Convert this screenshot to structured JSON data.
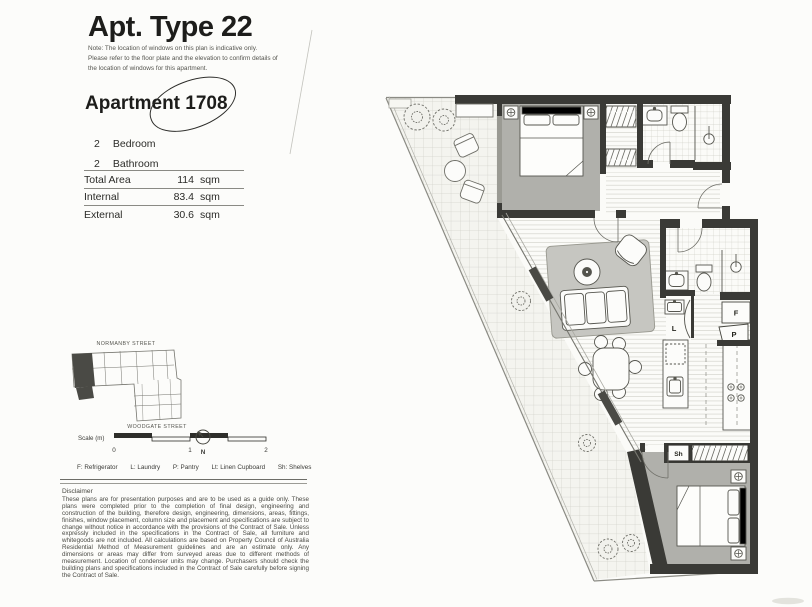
{
  "header": {
    "title": "Apt. Type 22",
    "note": "Note: The location of windows on this plan is indicative only. Please refer to the floor plate and the elevation to confirm details of the location of windows for this apartment.",
    "apartment_word": "Apartment",
    "apartment_number": "1708"
  },
  "summary": {
    "rooms": [
      {
        "count": "2",
        "label": "Bedroom"
      },
      {
        "count": "2",
        "label": "Bathroom"
      }
    ],
    "areas": [
      {
        "label": "Total Area",
        "value": "114",
        "unit": "sqm"
      },
      {
        "label": "Internal",
        "value": "83.4",
        "unit": "sqm"
      },
      {
        "label": "External",
        "value": "30.6",
        "unit": "sqm"
      }
    ]
  },
  "locator": {
    "street_top": "NORMANBY STREET",
    "street_bottom": "WOODGATE STREET"
  },
  "scale": {
    "label": "Scale (m)",
    "ticks": [
      "0",
      "1",
      "2"
    ],
    "north": "N"
  },
  "legend": {
    "items": [
      "F: Refrigerator",
      "L: Laundry",
      "P: Pantry",
      "Lt: Linen Cupboard",
      "Sh: Shelves"
    ]
  },
  "disclaimer": {
    "heading": "Disclaimer",
    "body": "These plans are for presentation purposes and are to be used as a guide only. These plans were completed prior to the completion of final design, engineering and construction of the building, therefore design, engineering, dimensions, areas, fittings, finishes, window placement, column size and placement and specifications are subject to change without notice in accordance with the provisions of the Contract of Sale. Unless expressly included in the specifications in the Contract of Sale, all furniture and whitegoods are not included. All calculations are based on Property Council of Australia Residential Method of Measurement guidelines and are an estimate only. Any dimensions or areas may differ from surveyed areas due to different methods of measurement. Location of condenser units may change. Purchasers should check the building plans and specifications included in the Contract of Sale carefully before signing the Contract of Sale."
  },
  "plan_labels": {
    "fridge": "F",
    "pantry": "P",
    "laundry": "L",
    "shelves": "Sh"
  }
}
